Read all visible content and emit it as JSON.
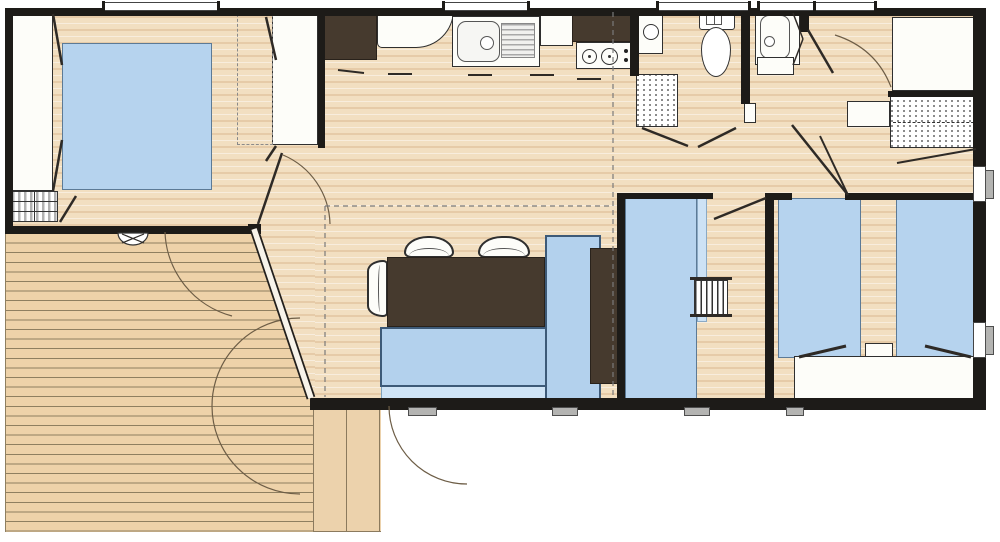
{
  "canvas": {
    "width": 1000,
    "height": 542
  },
  "colors": {
    "wall": "#1d1b18",
    "floor_wood": "#f2dfc1",
    "terrace_wood": "#eed2a9",
    "plank_line": "#8b7a5e",
    "furniture_blue": "#b6d3ee",
    "furniture_blue_light": "#cde2f5",
    "glass_blue": "#cfe4f6",
    "furniture_dark_brown": "#463a2e",
    "furniture_white": "#fdfdf9",
    "glazing_gray": "#b4b4b2",
    "swing_arc": "#6d5d46"
  },
  "elements": [
    {
      "n": "floor-interior",
      "k": "floor",
      "x": 10,
      "y": 10,
      "w": 967,
      "h": 392
    },
    {
      "n": "terrace-deck",
      "k": "terrace",
      "x": 5,
      "y": 233,
      "w": 310,
      "h": 299
    },
    {
      "n": "floor-bay-wedge",
      "k": "floor-wedge",
      "x": 253,
      "y": 230,
      "w": 62,
      "h": 170
    },
    {
      "n": "side-deck-strip",
      "k": "deck",
      "x": 313,
      "y": 400,
      "w": 68,
      "h": 132
    },
    {
      "n": "bay-glazing",
      "k": "glass",
      "x": 381,
      "y": 386,
      "w": 212,
      "h": 14
    },
    {
      "n": "wardrobe-master-left",
      "k": "white",
      "x": 11,
      "y": 13,
      "w": 42,
      "h": 178
    },
    {
      "n": "bed-master-double",
      "k": "bed",
      "x": 62,
      "y": 43,
      "w": 150,
      "h": 147
    },
    {
      "n": "drawer-unit-master",
      "k": "drawers",
      "x": 11,
      "y": 191,
      "w": 47,
      "h": 31
    },
    {
      "n": "wardrobe-master-right",
      "k": "white",
      "x": 272,
      "y": 14,
      "w": 46,
      "h": 131
    },
    {
      "n": "closet-zone-dashed",
      "k": "dashedrect",
      "x": 237,
      "y": 14,
      "w": 36,
      "h": 131
    },
    {
      "n": "fridge-unit",
      "k": "dark",
      "x": 322,
      "y": 10,
      "w": 55,
      "h": 50
    },
    {
      "n": "counter-corner",
      "k": "counter",
      "x": 377,
      "y": 10,
      "w": 77,
      "h": 38,
      "r": "0 0 46px 6px"
    },
    {
      "n": "kitchen-sink",
      "k": "sink",
      "x": 452,
      "y": 16,
      "w": 88,
      "h": 51
    },
    {
      "n": "counter-mid",
      "k": "white",
      "x": 540,
      "y": 12,
      "w": 33,
      "h": 34
    },
    {
      "n": "kitchen-tall-unit",
      "k": "dark",
      "x": 572,
      "y": 9,
      "w": 65,
      "h": 33
    },
    {
      "n": "hob",
      "k": "hob",
      "x": 576,
      "y": 42,
      "w": 58,
      "h": 27
    },
    {
      "n": "water-heater",
      "k": "heater",
      "x": 638,
      "y": 10,
      "w": 25,
      "h": 44
    },
    {
      "n": "cupboard-hatched",
      "k": "hatch",
      "x": 636,
      "y": 74,
      "w": 42,
      "h": 53
    },
    {
      "n": "toilet",
      "k": "toilet",
      "x": 698,
      "y": 11,
      "w": 38,
      "h": 66
    },
    {
      "n": "door-pivot-panel",
      "k": "white",
      "x": 744,
      "y": 103,
      "w": 12,
      "h": 20
    },
    {
      "n": "shower",
      "k": "shower",
      "x": 755,
      "y": 9,
      "w": 45,
      "h": 56
    },
    {
      "n": "washbasin-unit",
      "k": "white",
      "x": 757,
      "y": 57,
      "w": 37,
      "h": 18
    },
    {
      "n": "closet-corner",
      "k": "white",
      "x": 892,
      "y": 17,
      "w": 86,
      "h": 74
    },
    {
      "n": "shelf-unit-small",
      "k": "white",
      "x": 847,
      "y": 101,
      "w": 43,
      "h": 26
    },
    {
      "n": "shelving-hatched",
      "k": "hatch2",
      "x": 890,
      "y": 96,
      "w": 92,
      "h": 52
    },
    {
      "n": "bed-single-middle",
      "k": "bed",
      "x": 625,
      "y": 198,
      "w": 72,
      "h": 202
    },
    {
      "n": "bed-middle-edge",
      "k": "bed-light",
      "x": 697,
      "y": 198,
      "w": 10,
      "h": 124
    },
    {
      "n": "ladder-rail-top",
      "k": "darkline",
      "x": 690,
      "y": 277,
      "w": 42,
      "h": 3
    },
    {
      "n": "bunk-ladder",
      "k": "ladder",
      "x": 694,
      "y": 280,
      "w": 34,
      "h": 36
    },
    {
      "n": "ladder-rail-bottom",
      "k": "darkline",
      "x": 690,
      "y": 314,
      "w": 42,
      "h": 3
    },
    {
      "n": "bed-single-right-1",
      "k": "bed",
      "x": 778,
      "y": 198,
      "w": 83,
      "h": 160
    },
    {
      "n": "bed-single-right-2",
      "k": "bed",
      "x": 896,
      "y": 198,
      "w": 84,
      "h": 160
    },
    {
      "n": "nightstand",
      "k": "white",
      "x": 865,
      "y": 343,
      "w": 28,
      "h": 15
    },
    {
      "n": "storage-chest",
      "k": "white",
      "x": 794,
      "y": 356,
      "w": 180,
      "h": 44
    },
    {
      "n": "dining-chair-1",
      "k": "chair-n",
      "x": 404,
      "y": 236,
      "w": 50,
      "h": 22
    },
    {
      "n": "dining-chair-2",
      "k": "chair-n",
      "x": 478,
      "y": 236,
      "w": 52,
      "h": 22
    },
    {
      "n": "dining-chair-3",
      "k": "chair-w",
      "x": 367,
      "y": 260,
      "w": 21,
      "h": 57
    },
    {
      "n": "dining-table",
      "k": "dark",
      "x": 387,
      "y": 257,
      "w": 158,
      "h": 70
    },
    {
      "n": "sofa-bench",
      "k": "sofa",
      "x": 380,
      "y": 327,
      "w": 167,
      "h": 60
    },
    {
      "n": "sofa-chaise",
      "k": "sofa",
      "x": 545,
      "y": 235,
      "w": 56,
      "h": 165
    },
    {
      "n": "tv-cabinet",
      "k": "dark",
      "x": 590,
      "y": 248,
      "w": 28,
      "h": 136
    },
    {
      "n": "wall-top",
      "k": "wall",
      "x": 5,
      "y": 8,
      "w": 972,
      "h": 8
    },
    {
      "n": "wall-left",
      "k": "wall",
      "x": 5,
      "y": 8,
      "w": 8,
      "h": 226
    },
    {
      "n": "wall-master-south",
      "k": "wall",
      "x": 5,
      "y": 226,
      "w": 255,
      "h": 8
    },
    {
      "n": "wall-right",
      "k": "wall",
      "x": 973,
      "y": 8,
      "w": 13,
      "h": 402
    },
    {
      "n": "wall-south",
      "k": "wall",
      "x": 310,
      "y": 398,
      "w": 676,
      "h": 12
    },
    {
      "n": "wall-master-kitchen",
      "k": "wall",
      "x": 318,
      "y": 8,
      "w": 7,
      "h": 140
    },
    {
      "n": "wall-living-east",
      "k": "wall",
      "x": 617,
      "y": 193,
      "w": 8,
      "h": 215
    },
    {
      "n": "wall-midroom-north-a",
      "k": "wall",
      "x": 617,
      "y": 193,
      "w": 96,
      "h": 6
    },
    {
      "n": "wall-midroom-north-b",
      "k": "wall",
      "x": 765,
      "y": 193,
      "w": 12,
      "h": 6
    },
    {
      "n": "wall-mid-east",
      "k": "wall",
      "x": 765,
      "y": 193,
      "w": 9,
      "h": 215
    },
    {
      "n": "wall-rightroom-north-a",
      "k": "wall",
      "x": 774,
      "y": 193,
      "w": 18,
      "h": 7
    },
    {
      "n": "wall-rightroom-north-b",
      "k": "wall",
      "x": 845,
      "y": 193,
      "w": 140,
      "h": 7
    },
    {
      "n": "wall-closet-south",
      "k": "wall",
      "x": 888,
      "y": 91,
      "w": 96,
      "h": 6
    },
    {
      "n": "wall-wc-west",
      "k": "wall",
      "x": 630,
      "y": 8,
      "w": 9,
      "h": 68
    },
    {
      "n": "wall-wc-east",
      "k": "wall",
      "x": 741,
      "y": 8,
      "w": 9,
      "h": 96
    },
    {
      "n": "wall-shower-east-stub",
      "k": "wall",
      "x": 800,
      "y": 8,
      "w": 9,
      "h": 24
    },
    {
      "n": "wall-bay-cap",
      "k": "wall",
      "x": 248,
      "y": 224,
      "w": 13,
      "h": 10
    },
    {
      "n": "window-master",
      "k": "window-t",
      "x": 104,
      "y": 2,
      "w": 114,
      "h": 9
    },
    {
      "n": "window-kitchen",
      "k": "window-t",
      "x": 444,
      "y": 2,
      "w": 84,
      "h": 9
    },
    {
      "n": "window-wc",
      "k": "window-t",
      "x": 658,
      "y": 2,
      "w": 91,
      "h": 9
    },
    {
      "n": "window-bath",
      "k": "window-t",
      "x": 759,
      "y": 2,
      "w": 116,
      "h": 9
    },
    {
      "n": "window-bath-mullion",
      "k": "wall",
      "x": 813,
      "y": 1,
      "w": 3,
      "h": 12
    },
    {
      "n": "window-frame-east-1",
      "k": "winframe",
      "x": 973,
      "y": 166,
      "w": 13,
      "h": 36
    },
    {
      "n": "window-frame-east-2",
      "k": "winframe",
      "x": 973,
      "y": 322,
      "w": 13,
      "h": 36
    },
    {
      "n": "window-glazing-east-1",
      "k": "gray",
      "x": 985,
      "y": 170,
      "w": 9,
      "h": 29
    },
    {
      "n": "window-glazing-east-2",
      "k": "gray",
      "x": 985,
      "y": 326,
      "w": 9,
      "h": 29
    },
    {
      "n": "entry-step-1",
      "k": "gray",
      "x": 408,
      "y": 407,
      "w": 29,
      "h": 9
    },
    {
      "n": "entry-step-2",
      "k": "gray",
      "x": 552,
      "y": 407,
      "w": 26,
      "h": 9
    },
    {
      "n": "window-sill-mid-room",
      "k": "gray",
      "x": 684,
      "y": 407,
      "w": 26,
      "h": 9
    },
    {
      "n": "window-sill-right-room",
      "k": "gray",
      "x": 786,
      "y": 407,
      "w": 18,
      "h": 9
    }
  ],
  "svg": {
    "arcs": [
      {
        "n": "door-swing-terrace-a",
        "d": "M 165 232 A 90 90 0 0 0 232 316"
      },
      {
        "n": "door-swing-terrace-b",
        "d": "M 300 318 A 88 88 0 0 0 300 494"
      },
      {
        "n": "door-swing-entry",
        "d": "M 389 406 A 78 78 0 0 0 467 484"
      },
      {
        "n": "door-swing-master",
        "d": "M 283 155 A 77 77 0 0 1 330 224"
      },
      {
        "n": "door-swing-hall",
        "d": "M 835 35 Q 876 48 891 87"
      },
      {
        "n": "vent-dome",
        "d": "M 118 233 A 15 12 0 0 0 148 233 Z",
        "fill": "#ffffff",
        "stroke": "#333333"
      }
    ],
    "lines": [
      {
        "n": "bay-front-outer",
        "x1": 254,
        "y1": 229,
        "x2": 311,
        "y2": 398,
        "w": 9,
        "c": "#23201d"
      },
      {
        "n": "bay-front-glass",
        "x1": 254,
        "y1": 229,
        "x2": 311,
        "y2": 398,
        "w": 5.5,
        "c": "#f7f3ea"
      },
      {
        "n": "wardrobe-door-tl",
        "x1": 53,
        "y1": 14,
        "x2": 62,
        "y2": 65,
        "w": 2.5
      },
      {
        "n": "wardrobe-door-bl",
        "x1": 53,
        "y1": 191,
        "x2": 62,
        "y2": 140,
        "w": 2.5
      },
      {
        "n": "wardrobe-door-tr",
        "x1": 266,
        "y1": 17,
        "x2": 276,
        "y2": 60,
        "w": 2.5
      },
      {
        "n": "wardrobe-door-br",
        "x1": 266,
        "y1": 161,
        "x2": 276,
        "y2": 146,
        "w": 2.5
      },
      {
        "n": "drawer-door-open",
        "x1": 60,
        "y1": 222,
        "x2": 76,
        "y2": 196,
        "w": 2.5
      },
      {
        "n": "master-door-leaf",
        "x1": 258,
        "y1": 224,
        "x2": 282,
        "y2": 153,
        "w": 2.5
      },
      {
        "n": "wc-door-leaf-a",
        "x1": 642,
        "y1": 128,
        "x2": 688,
        "y2": 146,
        "w": 2.5
      },
      {
        "n": "wc-door-leaf-b",
        "x1": 736,
        "y1": 128,
        "x2": 698,
        "y2": 147,
        "w": 2.5
      },
      {
        "n": "shower-fold-a",
        "x1": 793,
        "y1": 13,
        "x2": 803,
        "y2": 39,
        "w": 1.5
      },
      {
        "n": "shower-fold-b",
        "x1": 803,
        "y1": 39,
        "x2": 793,
        "y2": 65,
        "w": 1.5
      },
      {
        "n": "hall-door-leaf",
        "x1": 808,
        "y1": 30,
        "x2": 833,
        "y2": 73,
        "w": 2.5
      },
      {
        "n": "closet-door-open",
        "x1": 897,
        "y1": 163,
        "x2": 976,
        "y2": 149,
        "w": 2
      },
      {
        "n": "rightroom-door-leaf-a",
        "x1": 792,
        "y1": 125,
        "x2": 848,
        "y2": 195,
        "w": 2.5
      },
      {
        "n": "rightroom-door-leaf-b",
        "x1": 820,
        "y1": 136,
        "x2": 848,
        "y2": 195,
        "w": 2
      },
      {
        "n": "midroom-door-leaf",
        "x1": 714,
        "y1": 219,
        "x2": 766,
        "y2": 198,
        "w": 2.5
      },
      {
        "n": "chest-detail-left",
        "x1": 799,
        "y1": 357,
        "x2": 846,
        "y2": 346,
        "w": 3
      },
      {
        "n": "chest-detail-right",
        "x1": 925,
        "y1": 346,
        "x2": 971,
        "y2": 357,
        "w": 3
      },
      {
        "n": "counter-handle-1",
        "x1": 338,
        "y1": 70,
        "x2": 364,
        "y2": 73,
        "w": 2
      },
      {
        "n": "counter-handle-2",
        "x1": 388,
        "y1": 74,
        "x2": 412,
        "y2": 74,
        "w": 2
      },
      {
        "n": "counter-handle-3",
        "x1": 468,
        "y1": 75,
        "x2": 492,
        "y2": 75,
        "w": 2
      },
      {
        "n": "counter-handle-4",
        "x1": 530,
        "y1": 75,
        "x2": 554,
        "y2": 75,
        "w": 2
      },
      {
        "n": "counter-handle-5",
        "x1": 577,
        "y1": 79,
        "x2": 601,
        "y2": 79,
        "w": 2
      },
      {
        "n": "vent-cross-1",
        "x1": 122,
        "y1": 234,
        "x2": 144,
        "y2": 243,
        "w": 1.2
      },
      {
        "n": "vent-cross-2",
        "x1": 144,
        "y1": 234,
        "x2": 122,
        "y2": 243,
        "w": 1.2
      }
    ],
    "dashed": [
      {
        "n": "roofline-vertical",
        "x1": 613,
        "y1": 12,
        "x2": 613,
        "y2": 396
      },
      {
        "n": "roofline-horizontal",
        "x1": 325,
        "y1": 206,
        "x2": 612,
        "y2": 206
      },
      {
        "n": "roofline-vertical-2",
        "x1": 325,
        "y1": 206,
        "x2": 325,
        "y2": 397
      }
    ]
  }
}
